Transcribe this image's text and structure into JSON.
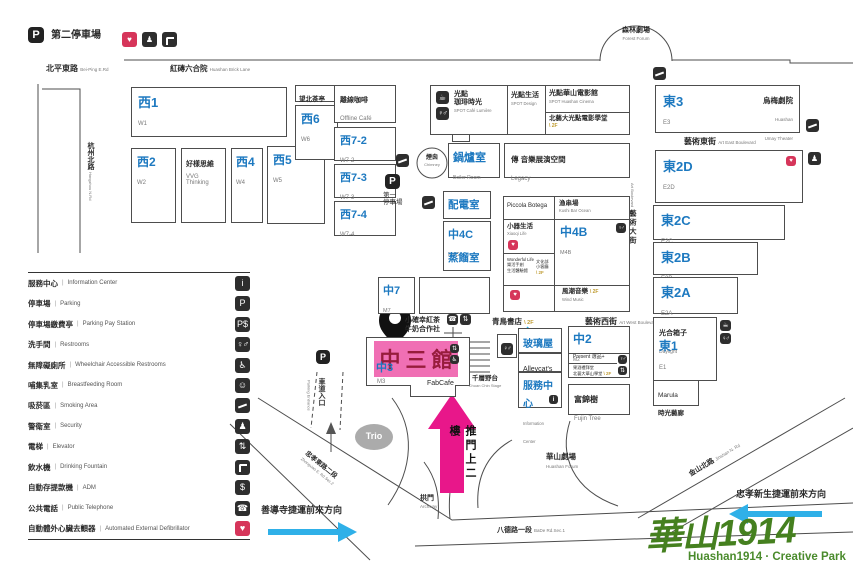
{
  "colors": {
    "blue": "#1d79c0",
    "pink": "#f06fb4",
    "magenta": "#e8178a",
    "arrow_blue": "#2fb0e8",
    "logo_green": "#45801f",
    "hall_red": "#971c3c",
    "gold": "#bf9b30"
  },
  "header": {
    "p_glyph": "P",
    "p2_label": "第二停車場"
  },
  "legend": {
    "items": [
      {
        "zh": "服務中心",
        "en": "Information Center",
        "icon": "info"
      },
      {
        "zh": "停車場",
        "en": "Parking",
        "icon": "parking"
      },
      {
        "zh": "停車場繳費亭",
        "en": "Parking Pay Station",
        "icon": "parking-pay"
      },
      {
        "zh": "洗手間",
        "en": "Restrooms",
        "icon": "restroom"
      },
      {
        "zh": "無障礙廁所",
        "en": "Wheelchair Accessible Restrooms",
        "icon": "wheelchair"
      },
      {
        "zh": "哺集乳室",
        "en": "Breastfeeding Room",
        "icon": "breastfeeding"
      },
      {
        "zh": "吸菸區",
        "en": "Smoking Area",
        "icon": "smoking"
      },
      {
        "zh": "警衛室",
        "en": "Security",
        "icon": "security"
      },
      {
        "zh": "電梯",
        "en": "Elevator",
        "icon": "elevator"
      },
      {
        "zh": "飲水機",
        "en": "Drinking Fountain",
        "icon": "drinking-fountain"
      },
      {
        "zh": "自動存提款機",
        "en": "ADM",
        "icon": "atm"
      },
      {
        "zh": "公共電話",
        "en": "Public Telephone",
        "icon": "phone"
      },
      {
        "zh": "自動體外心臟去顫器",
        "en": "Automated External Defibrillator",
        "icon": "aed"
      }
    ]
  },
  "icon_glyphs": {
    "info": "i",
    "parking": "P",
    "parking-pay": "P$",
    "restroom": "♀♂",
    "wheelchair": "♿",
    "breastfeeding": "☺",
    "smoking": "",
    "security": "♟",
    "elevator": "⇅",
    "drinking-fountain": "",
    "atm": "$",
    "phone": "☎",
    "aed": "♥",
    "coffee": "☕"
  },
  "streets": {
    "beiping": "北平東路",
    "beipinge": "Bei-Ping E.Rd",
    "hangzhou": "杭州北路",
    "hangzhoue": "Hangzhou N.Rd",
    "brick": "紅磚六合院",
    "bricke": "Huashan Brick Lane",
    "arteast": "藝術東街",
    "artease": "Art East Boulevard",
    "artwest": "藝術西街",
    "artwese": "Art West Boulevard",
    "artblvd": "藝術大街",
    "artblvde": "Art Boulevard",
    "zhongxiao": "忠孝東路二段",
    "zhongxiaoe": "Zhongxiao E. Rd.Sec.2",
    "bade": "八德路一段",
    "badee": "BaDe Rd.Sec.1",
    "jinshan": "金山北路",
    "jinshane": "Jinshan N. Rd"
  },
  "map": {
    "w1": "西1",
    "w1e": "W1",
    "w2": "西2",
    "w2e": "W2",
    "vvg": "好樣思維",
    "vvge": "VVG Thinking",
    "w4": "西4",
    "w4e": "W4",
    "w5": "西5",
    "w5e": "W5",
    "wangbei": "望北茶亭",
    "w6": "西6",
    "w6e": "W6",
    "offline": "離線咖啡",
    "offlinee": "Offline Café",
    "w72": "西7-2",
    "w72e": "W7-2",
    "w73": "西7-3",
    "w73e": "W7-3",
    "w74": "西7-4",
    "w74e": "W7-4",
    "spotcafe1": "光點",
    "spotcafe2": "珈琲時光",
    "spotcafee": "SPOT Café Lumière",
    "spotdesign": "光點生活",
    "spotdesigne": "SPOT Design",
    "spotcinema": "光點華山電影館",
    "spotcinemae": "SPOT Huashan Cinema",
    "spotschool": "北藝大光點電影學堂",
    "fl2": "2F",
    "chimney": "煙囪",
    "chimneye": "Chimney",
    "boiler": "鍋爐室",
    "boilere": "Boiler Room",
    "legacy": "傳 音樂展演空間",
    "legacye": "Legacy",
    "p1a": "第一",
    "p1b": "停車場",
    "electrical": "配電室",
    "electricale": "Electrical room",
    "m4c": "中4C",
    "m4ce": "M4C",
    "distill": "蒸餾室",
    "piccola": "Piccola Botega",
    "kushi": "漁串場",
    "kushie": "Kushi Bar Ocean",
    "xiaoqi": "小器生活",
    "xiaoqie": "Xiaoqi Life",
    "m4b": "中4B",
    "m4be": "M4B",
    "wl1": "Wonderful Life",
    "wl2": "樂活手創",
    "wl3": "生活體驗館",
    "cul1": "文化部",
    "cul2": "小客廳",
    "wind": "風潮音樂",
    "winde": "Wind Music",
    "bluebird": "青鳥書店",
    "m7": "中7",
    "m7e": "M7",
    "hap1": "小確幸紅茶",
    "hap2": "牛奶合作社",
    "hall": "中三館",
    "m3": "中3",
    "m3e": "M3",
    "fabcafe": "FabCafe",
    "stage": "千層野台",
    "stagee": "Chuan Chin Stage",
    "glass": "玻璃屋",
    "alleycats": "Alleycat's",
    "infoc": "服務中心",
    "infoce": "Information Center",
    "m2": "中2",
    "m2e": "M2",
    "present": "Present 選品+",
    "fruit1": "果酒禮拜堂",
    "fruit2": "北藝大華山學堂",
    "fujin": "富錦樹",
    "fujine": "Fujin Tree",
    "forest": "森林劇場",
    "foreste": "Forest Forum",
    "e3": "東3",
    "e3e": "E3",
    "umay": "烏梅劇院",
    "umaye1": "Huashan",
    "umaye2": "Umay Theater",
    "e2d": "東2D",
    "e2de": "E2D",
    "e2c": "東2C",
    "e2ce": "E2C",
    "e2b": "東2B",
    "e2be": "E2B",
    "e2a": "東2A",
    "e2ae": "E2A",
    "daylight": "光合箱子",
    "daylighte": "Daylight",
    "e1": "東1",
    "e1e": "E1",
    "marula1": "Marula",
    "marula2": "時光藝廊",
    "forum": "華山劇場",
    "forume": "Huashan Forum",
    "arch": "拱門",
    "arche": "Archway",
    "trio": "Trio"
  },
  "directions": {
    "shandao": "善導寺捷運前來方向",
    "xinsheng": "忠孝新生捷運前來方向",
    "push_door": "推門上二樓",
    "driveway": "車道入口",
    "driveway_en": "Parking Entrance"
  },
  "logo": {
    "zh": "華山1914",
    "en": "Huashan1914 · Creative Park"
  }
}
